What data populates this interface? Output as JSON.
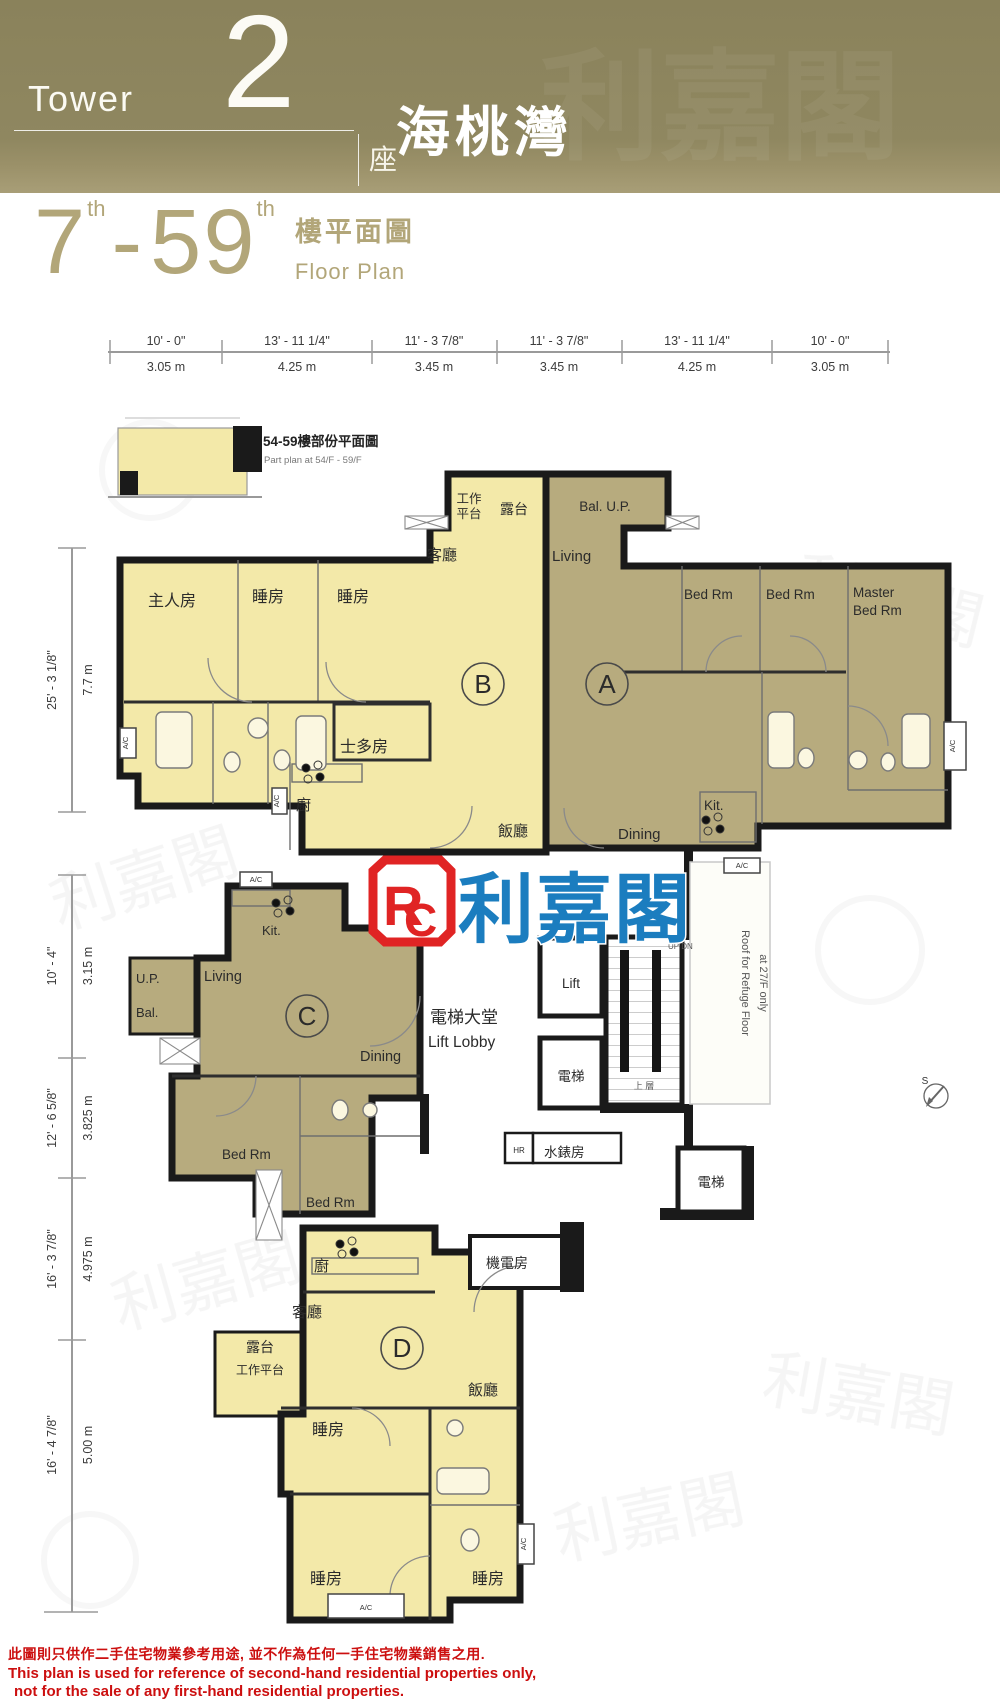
{
  "header": {
    "tower_en": "Tower",
    "tower_no": "2",
    "tower_zh": "座",
    "project": "海桃灣"
  },
  "title": {
    "from": "7",
    "sup": "th",
    "dash": "-",
    "to": "59",
    "zh": "樓平面圖",
    "en": "Floor Plan"
  },
  "part_plan": {
    "zh": "54-59樓部份平面圖",
    "en": "Part plan at 54/F - 59/F"
  },
  "top_dims": [
    {
      "ft": "10' - 0\"",
      "m": "3.05 m"
    },
    {
      "ft": "13' - 11 1/4\"",
      "m": "4.25 m"
    },
    {
      "ft": "11' - 3 7/8\"",
      "m": "3.45 m"
    },
    {
      "ft": "11' - 3 7/8\"",
      "m": "3.45 m"
    },
    {
      "ft": "13' - 11 1/4\"",
      "m": "4.25 m"
    },
    {
      "ft": "10' - 0\"",
      "m": "3.05 m"
    }
  ],
  "left_dims": [
    {
      "ft": "25' - 3 1/8\"",
      "m": "7.7 m"
    },
    {
      "ft": "10' - 4\"",
      "m": "3.15 m"
    },
    {
      "ft": "12' - 6 5/8\"",
      "m": "3.825 m"
    },
    {
      "ft": "16' - 3 7/8\"",
      "m": "4.975 m"
    },
    {
      "ft": "16' - 4 7/8\"",
      "m": "5.00 m"
    }
  ],
  "flat_a": {
    "unit": "A",
    "balcony": "Bal. U.P.",
    "living": "Living",
    "bed1": "Bed Rm",
    "bed2": "Bed Rm",
    "master_l1": "Master",
    "master_l2": "Bed Rm",
    "kitchen": "Kit.",
    "dining": "Dining"
  },
  "flat_b": {
    "unit": "B",
    "work_l1": "工作",
    "work_l2": "平台",
    "balcony": "露台",
    "living": "客廳",
    "master": "主人房",
    "bed1": "睡房",
    "bed2": "睡房",
    "store": "士多房",
    "kitchen": "廚",
    "dining": "飯廳"
  },
  "flat_c": {
    "unit": "C",
    "up": "U.P.",
    "bal": "Bal.",
    "living": "Living",
    "dining": "Dining",
    "kitchen": "Kit.",
    "bed1": "Bed Rm",
    "bed2": "Bed Rm"
  },
  "flat_d": {
    "unit": "D",
    "kitchen": "廚",
    "living": "客廳",
    "balcony": "露台",
    "work": "工作平台",
    "dining": "飯廳",
    "bed1": "睡房",
    "bed2": "睡房",
    "bed3": "睡房"
  },
  "core": {
    "lobby_zh": "電梯大堂",
    "lobby_en": "Lift Lobby",
    "lift_en": "Lift",
    "lift_zh": "電梯",
    "hr": "HR",
    "water": "水錶房",
    "em": "機電房",
    "updn": "UP DN",
    "upper": "上 層",
    "refuge1": "Roof for Refuge Floor",
    "refuge2": "at 27/F only",
    "ac": "A/C",
    "compass": "S"
  },
  "logo": {
    "r": "R",
    "c": "C",
    "name": "利嘉閣"
  },
  "disclaimer": {
    "zh": "此圖則只供作二手住宅物業參考用途, 並不作為任何一手住宅物業銷售之用.",
    "en1": "This plan is used for reference of second-hand residential properties only,",
    "en2": "not for the sale of any first-hand residential properties."
  },
  "colors": {
    "flat_yellow": "#f3e9a9",
    "flat_khaki": "#b7ab7e",
    "banner": "#8d8560",
    "logo_red": "#e02424",
    "logo_blue": "#1b7dbf",
    "disclaimer_red": "#cc0f0f"
  }
}
